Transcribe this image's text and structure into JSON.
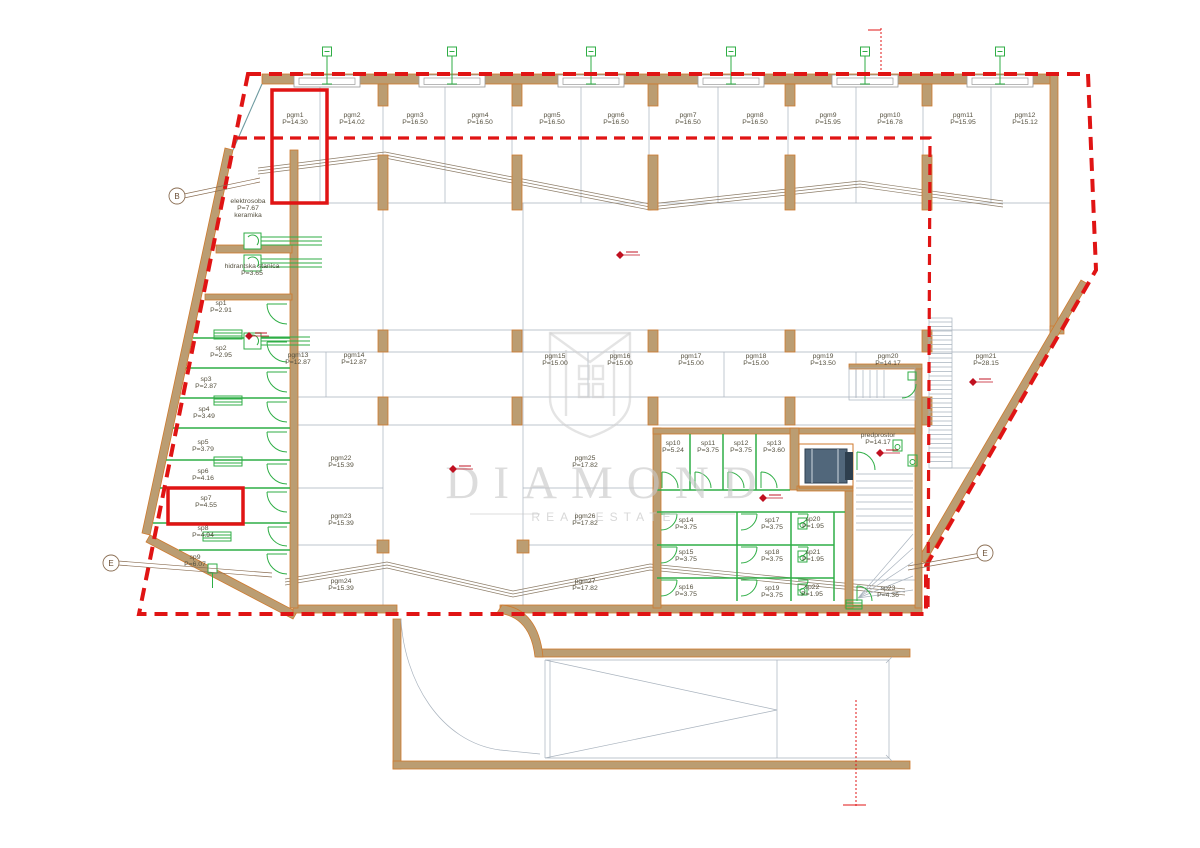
{
  "watermark": {
    "title": "DIAMOND",
    "subtitle": "REAL ESTATE"
  },
  "colors": {
    "boundary": "#e01414",
    "highlight": "#e01414",
    "wall_fill": "#bb9d72",
    "wall_stroke": "#cf7a2e",
    "green": "#2fae46",
    "thin": "#a9b3be",
    "marker": "#c01020"
  },
  "rooms": [
    {
      "id": "pgm1",
      "area": "P=14.30",
      "x": 295,
      "y": 117
    },
    {
      "id": "pgm2",
      "area": "P=14.02",
      "x": 352,
      "y": 117
    },
    {
      "id": "pgm3",
      "area": "P=16.50",
      "x": 415,
      "y": 117
    },
    {
      "id": "pgm4",
      "area": "P=16.50",
      "x": 480,
      "y": 117
    },
    {
      "id": "pgm5",
      "area": "P=16.50",
      "x": 552,
      "y": 117
    },
    {
      "id": "pgm6",
      "area": "P=16.50",
      "x": 616,
      "y": 117
    },
    {
      "id": "pgm7",
      "area": "P=16.50",
      "x": 688,
      "y": 117
    },
    {
      "id": "pgm8",
      "area": "P=16.50",
      "x": 755,
      "y": 117
    },
    {
      "id": "pgm9",
      "area": "P=15.95",
      "x": 828,
      "y": 117
    },
    {
      "id": "pgm10",
      "area": "P=16.78",
      "x": 890,
      "y": 117
    },
    {
      "id": "pgm11",
      "area": "P=15.95",
      "x": 963,
      "y": 117
    },
    {
      "id": "pgm12",
      "area": "P=15.12",
      "x": 1025,
      "y": 117
    },
    {
      "id": "pgm13",
      "area": "P=12.87",
      "x": 298,
      "y": 357
    },
    {
      "id": "pgm14",
      "area": "P=12.87",
      "x": 354,
      "y": 357
    },
    {
      "id": "pgm15",
      "area": "P=15.00",
      "x": 555,
      "y": 358
    },
    {
      "id": "pgm16",
      "area": "P=15.00",
      "x": 620,
      "y": 358
    },
    {
      "id": "pgm17",
      "area": "P=15.00",
      "x": 691,
      "y": 358
    },
    {
      "id": "pgm18",
      "area": "P=15.00",
      "x": 756,
      "y": 358
    },
    {
      "id": "pgm19",
      "area": "P=13.50",
      "x": 823,
      "y": 358
    },
    {
      "id": "pgm20",
      "area": "P=14.17",
      "x": 888,
      "y": 358
    },
    {
      "id": "pgm21",
      "area": "P=28.15",
      "x": 986,
      "y": 358
    },
    {
      "id": "pgm22",
      "area": "P=15.39",
      "x": 341,
      "y": 460
    },
    {
      "id": "pgm23",
      "area": "P=15.39",
      "x": 341,
      "y": 518
    },
    {
      "id": "pgm24",
      "area": "P=15.39",
      "x": 341,
      "y": 583
    },
    {
      "id": "pgm25",
      "area": "P=17.82",
      "x": 585,
      "y": 460
    },
    {
      "id": "pgm26",
      "area": "P=17.82",
      "x": 585,
      "y": 518
    },
    {
      "id": "pgm27",
      "area": "P=17.82",
      "x": 585,
      "y": 583
    },
    {
      "id": "elektrosoba",
      "area": "P=7.67",
      "note": "keramika",
      "x": 248,
      "y": 203
    },
    {
      "id": "hidrantska stanica",
      "area": "P=3.65",
      "x": 252,
      "y": 268
    },
    {
      "id": "sp1",
      "area": "P=2.91",
      "x": 221,
      "y": 305
    },
    {
      "id": "sp2",
      "area": "P=2.95",
      "x": 221,
      "y": 350
    },
    {
      "id": "sp3",
      "area": "P=2.87",
      "x": 206,
      "y": 381
    },
    {
      "id": "sp4",
      "area": "P=3.49",
      "x": 204,
      "y": 411
    },
    {
      "id": "sp5",
      "area": "P=3.79",
      "x": 203,
      "y": 444
    },
    {
      "id": "sp6",
      "area": "P=4.16",
      "x": 203,
      "y": 473
    },
    {
      "id": "sp7",
      "area": "P=4.55",
      "x": 206,
      "y": 500
    },
    {
      "id": "sp8",
      "area": "P=4.94",
      "x": 203,
      "y": 530
    },
    {
      "id": "sp9",
      "area": "P=6.07",
      "x": 195,
      "y": 559
    },
    {
      "id": "sp10",
      "area": "P=5.24",
      "x": 673,
      "y": 445
    },
    {
      "id": "sp11",
      "area": "P=3.75",
      "x": 708,
      "y": 445
    },
    {
      "id": "sp12",
      "area": "P=3.75",
      "x": 741,
      "y": 445
    },
    {
      "id": "sp13",
      "area": "P=3.60",
      "x": 774,
      "y": 445
    },
    {
      "id": "predprostor",
      "area": "P=14.17",
      "x": 878,
      "y": 437
    },
    {
      "id": "sp14",
      "area": "P=3.75",
      "x": 686,
      "y": 522
    },
    {
      "id": "sp15",
      "area": "P=3.75",
      "x": 686,
      "y": 554
    },
    {
      "id": "sp16",
      "area": "P=3.75",
      "x": 686,
      "y": 589
    },
    {
      "id": "sp17",
      "area": "P=3.75",
      "x": 772,
      "y": 522
    },
    {
      "id": "sp18",
      "area": "P=3.75",
      "x": 772,
      "y": 554
    },
    {
      "id": "sp19",
      "area": "P=3.75",
      "x": 772,
      "y": 590
    },
    {
      "id": "sp20",
      "area": "P=1.95",
      "x": 813,
      "y": 521
    },
    {
      "id": "sp21",
      "area": "P=1.95",
      "x": 813,
      "y": 554
    },
    {
      "id": "sp22",
      "area": "P=1.95",
      "x": 812,
      "y": 589
    },
    {
      "id": "sp23",
      "area": "P=4.36",
      "x": 888,
      "y": 590
    }
  ],
  "references": [
    {
      "label": "B",
      "x": 177,
      "y": 196,
      "lx": 260,
      "ly": 182
    },
    {
      "label": "E",
      "x": 111,
      "y": 563,
      "lx": 272,
      "ly": 577
    },
    {
      "label": "E",
      "x": 985,
      "y": 553,
      "lx": 908,
      "ly": 570
    }
  ],
  "highlights": [
    {
      "x": 272,
      "y": 90,
      "w": 55,
      "h": 113
    },
    {
      "x": 168,
      "y": 488,
      "w": 75,
      "h": 36
    }
  ],
  "fixtures": {
    "vent_xs": [
      327,
      452,
      591,
      731,
      865,
      1000
    ],
    "elevation_markers": [
      [
        620,
        255
      ],
      [
        453,
        469
      ],
      [
        249,
        336
      ],
      [
        973,
        382
      ],
      [
        880,
        453
      ],
      [
        763,
        498
      ]
    ]
  }
}
